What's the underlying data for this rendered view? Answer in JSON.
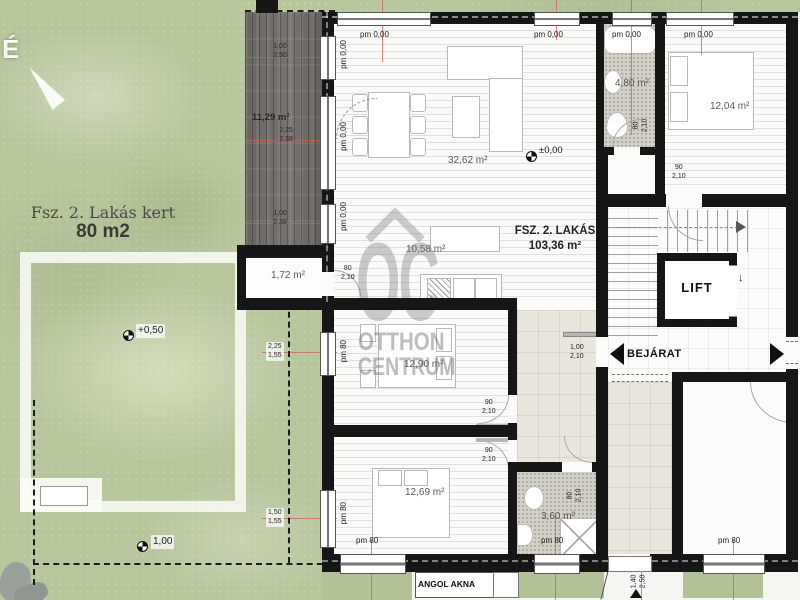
{
  "compass": {
    "north": "É"
  },
  "garden": {
    "title": "Fsz. 2. Lakás kert",
    "area": "80 m2",
    "level_terrain": "+0,50",
    "level_boundary": "1,00",
    "window_dims": [
      {
        "w": "2,25",
        "h": "1,55"
      },
      {
        "w": "1,50",
        "h": "1,55"
      }
    ]
  },
  "terrace": {
    "area": "11,29 m²",
    "openings": [
      {
        "w": "1,00",
        "h": "2,50"
      },
      {
        "w": "2,25",
        "h": "2,38"
      },
      {
        "w": "1,00",
        "h": "2,38"
      }
    ]
  },
  "apartment": {
    "name": "FSZ. 2. LAKÁS",
    "area": "103,36 m²",
    "level": "±0,00",
    "rooms": {
      "living": "32,62 m²",
      "kitchen": "10,58 m²",
      "bedroom1": "12,90 m²",
      "bedroom2": "12,69 m²",
      "bathroom": "3,60 m²",
      "bathroom_top": "4,80 m²",
      "vestibule": "1,72 m²"
    }
  },
  "neighbor": {
    "bedroom": "12,04 m²"
  },
  "window_labels": {
    "pm0": "pm 0,00",
    "pm80": "pm 80"
  },
  "door_dims": {
    "d80": "80",
    "d90": "90",
    "d100": "1,00",
    "h210": "2,10"
  },
  "bottom_opening": {
    "w": "1,40",
    "h": "2,50"
  },
  "core": {
    "lift": "LIFT",
    "lift_arrow": "↓",
    "entrance": "BEJÁRAT",
    "shaft": "ANGOL AKNA"
  },
  "watermark": {
    "monogram": "OC",
    "line1": "OTTHON",
    "line2": "CENTRUM"
  },
  "colors": {
    "wall": "#161616",
    "garden": "#b7c69b",
    "deck": "#6b6661",
    "guide_red": "#c96057"
  }
}
